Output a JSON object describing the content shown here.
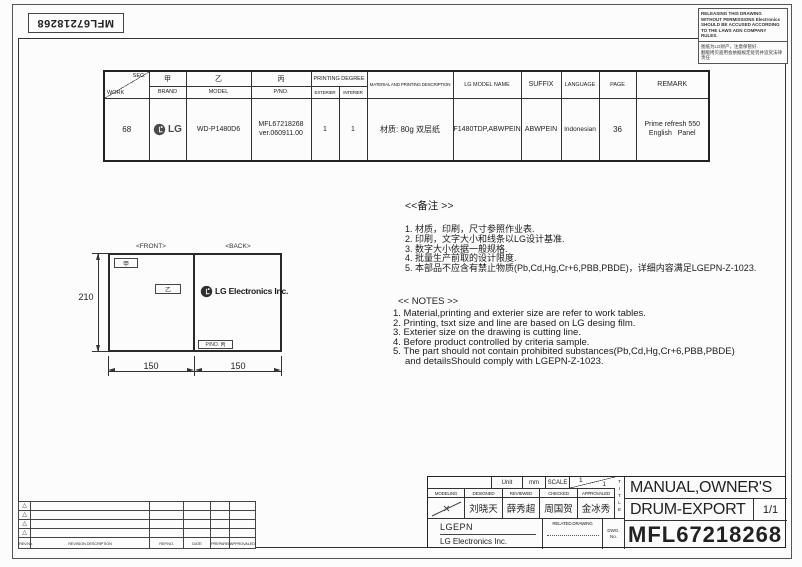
{
  "sheet": {
    "barcode_text": "MFL67218268",
    "warning_box": {
      "en_line1": "RELEASING THIS DRAWING",
      "en_line2": "WITHOUT PERMISSIONS Electronics",
      "en_line3": "SHOULD BE ACCUSED ACCORDING",
      "en_line4": "TO THE LAWS ADN COMPANY",
      "en_line5": "RULES.",
      "cn_line1": "图纸为LG财产，注意保管好.",
      "cn_line2": "翻版拷贝盗用会依据规定处罚并追究法律责任"
    }
  },
  "work_table": {
    "corner": {
      "top": "SEC.",
      "bottom": "WORK"
    },
    "headers": {
      "brand_cn": "甲",
      "brand_en": "BRAND",
      "model_cn": "乙",
      "model_en": "MODEL",
      "pno_cn": "丙",
      "pno_en": "P/NO.",
      "printing_degree": "PRINTING DEGREE",
      "exterier": "EXTERIER",
      "interier": "INTERIER",
      "material": "MATERIAL AND PRINTING DESCRIPTION",
      "lg_model_name": "LG MODEL NAME",
      "suffix": "SUFFIX",
      "language": "LANGUAGE",
      "page": "PAGE",
      "remark": "REMARK"
    },
    "row": {
      "work": "68",
      "brand": "LG",
      "model": "WD-P1480D6",
      "pno_line1": "MFL67218268",
      "pno_line2": "ver.060911.00",
      "exterier": "1",
      "interier": "1",
      "material": "材质: 80g 双层纸",
      "lg_model_name": "F1480TDP,ABWPEIN",
      "suffix": "ABWPEIN",
      "language": "Indonesian",
      "page": "36",
      "remark_line1": "Prime refresh 550",
      "remark_line2": "English   Panel"
    }
  },
  "drawing": {
    "front_label": "<FRONT>",
    "back_label": "<BACK>",
    "height_dim": "210",
    "width_dim_front": "150",
    "width_dim_back": "150",
    "front_tag_top": "甲",
    "front_tag_mid": "乙",
    "back_logo_text": "LG Electronics Inc.",
    "back_pno_tag": "P/NO. 丙"
  },
  "notes_cn": {
    "title": "<<备注 >>",
    "items": [
      "1.  材质，印刷，尺寸参照作业表.",
      "2.  印刷，文字大小和线条以LG设计基准.",
      "3.  数字大小依据一般规格.",
      "4.  批量生产前取的设计限度.",
      "5.  本部品不应含有禁止物质(Pb,Cd,Hg,Cr+6,PBB,PBDE)，详细内容满足LGEPN-Z-1023."
    ]
  },
  "notes_en": {
    "title": "<< NOTES >>",
    "items": [
      "1. Material,printing and exterier size are refer to work tables.",
      "2. Printing, tsxt  size and line are based on LG desing film.",
      "3. Exterier size on the drawing is cutting line.",
      "4. Before product controlled by criteria sample.",
      "5. The part should not contain prohibited substances(Pb,Cd,Hg,Cr+6,PBB,PBDE)",
      "and detailsShould comply with LGEPN-Z-1023."
    ]
  },
  "revision_table": {
    "marker": "△",
    "headers": {
      "rev_no": "REV.No.",
      "description": "REVISION DESCRIPTION",
      "rep_no": "REP.NO.",
      "date": "DATE",
      "prepared": "PREPARED",
      "approvaled": "APPROVALED"
    }
  },
  "title_block": {
    "unit_label": "Unit",
    "unit_value": "mm",
    "scale_label": "SCALE",
    "scale_top": "1",
    "scale_bottom": "1",
    "roles": {
      "modeling": "MODELING",
      "designed": "DESIGNED",
      "reviewed": "REVIEWED",
      "checked": "CHECKED",
      "approvaled": "APPROVALED"
    },
    "names": {
      "designed": "刘晓天",
      "reviewed": "薛秀超",
      "checked": "周国贺",
      "approvaled": "金冰秀"
    },
    "company_short": "LGEPN",
    "company_full": "LG Electronics Inc.",
    "related_drawing": "RELATED DRAWING",
    "dwg_label_line1": "DWG.",
    "dwg_label_line2": "No.",
    "title_vertical": [
      "T",
      "I",
      "T",
      "L",
      "E"
    ],
    "title_line1": "MANUAL,OWNER'S",
    "title_line2": "DRUM-EXPORT",
    "sheet_no": "1/1",
    "dwg_no": "MFL67218268"
  },
  "colors": {
    "ink": "#1a1a1a",
    "line": "#333333",
    "lg_gray": "#4a4a4a",
    "paper": "#fcfcfc"
  }
}
